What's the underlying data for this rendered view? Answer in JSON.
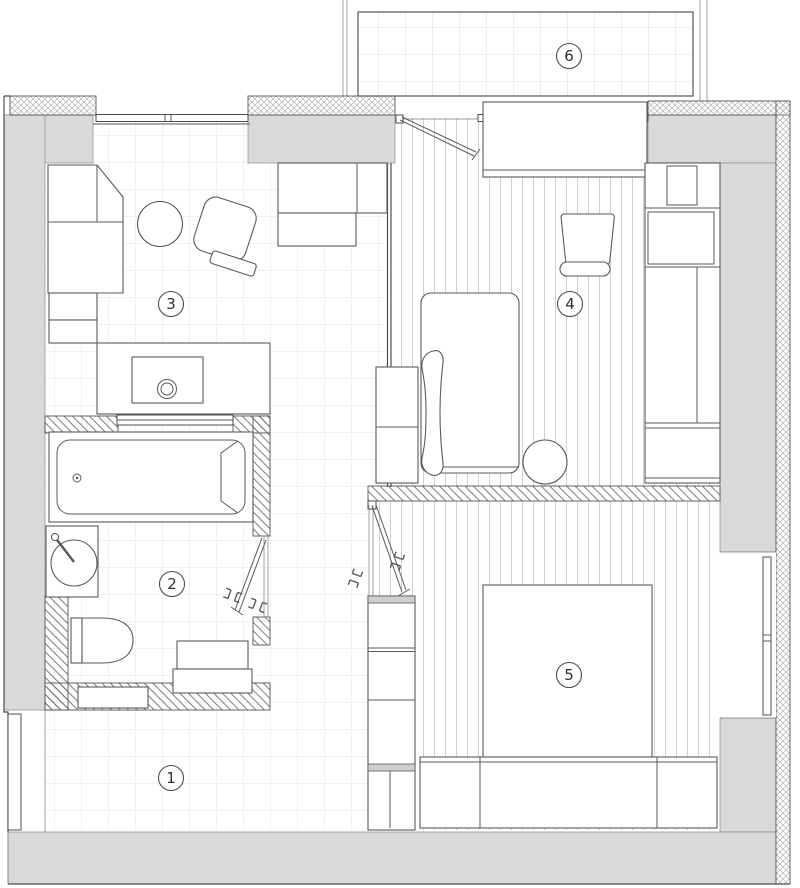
{
  "plan": {
    "rooms": [
      {
        "label": "1",
        "name": "hallway"
      },
      {
        "label": "2",
        "name": "bathroom"
      },
      {
        "label": "3",
        "name": "living-kitchen"
      },
      {
        "label": "4",
        "name": "bedroom"
      },
      {
        "label": "5",
        "name": "bedroom-2"
      },
      {
        "label": "6",
        "name": "balcony"
      }
    ],
    "colors": {
      "background": "#ffffff",
      "wall_fill": "#d9d9d9",
      "wall_line": "#4c4c4c",
      "furniture_line": "#5a5a5a",
      "tile_grid_line": "#e9e2dd",
      "balcony_grid_line": "#dedede",
      "plank_line": "#cccccc",
      "hatch_line": "#6f6f6f",
      "crosshatch_line": "#b3b3b3",
      "label_text": "#2e2e2e"
    }
  }
}
